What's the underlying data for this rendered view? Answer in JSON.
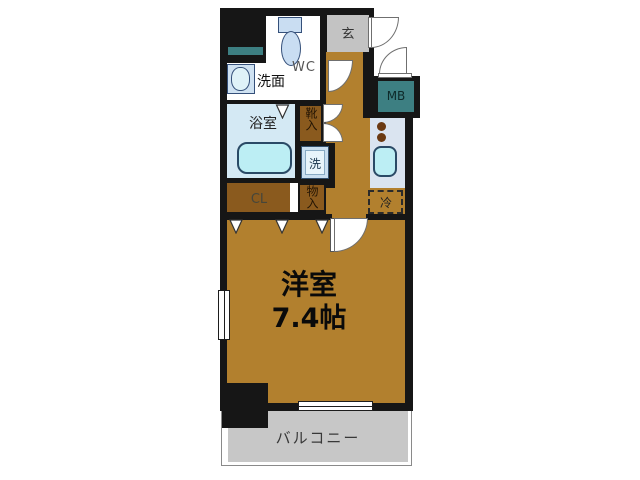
{
  "plan_type": "apartment-floor-plan",
  "labels": {
    "genkan": "玄",
    "wc": "WC",
    "senmen": "洗面",
    "bath": "浴室",
    "shoe": "靴入",
    "washer": "洗",
    "storage": "物入",
    "closet": "CL",
    "meter": "MB",
    "fridge": "冷",
    "room_name": "洋室",
    "room_size": "7.4帖",
    "balcony": "バルコニー"
  },
  "colors": {
    "wall": "#161616",
    "floor": "#b2802e",
    "closet": "#8a5a1e",
    "entrance": "#c3c3c3",
    "balcony": "#c7c7c7",
    "teal": "#3d7f82",
    "bath": "#d4e9f4",
    "counter": "#dae4f0",
    "fixture": "#bceef4",
    "fixture_border": "#2a4a66",
    "washer_bg": "#c9def0"
  }
}
